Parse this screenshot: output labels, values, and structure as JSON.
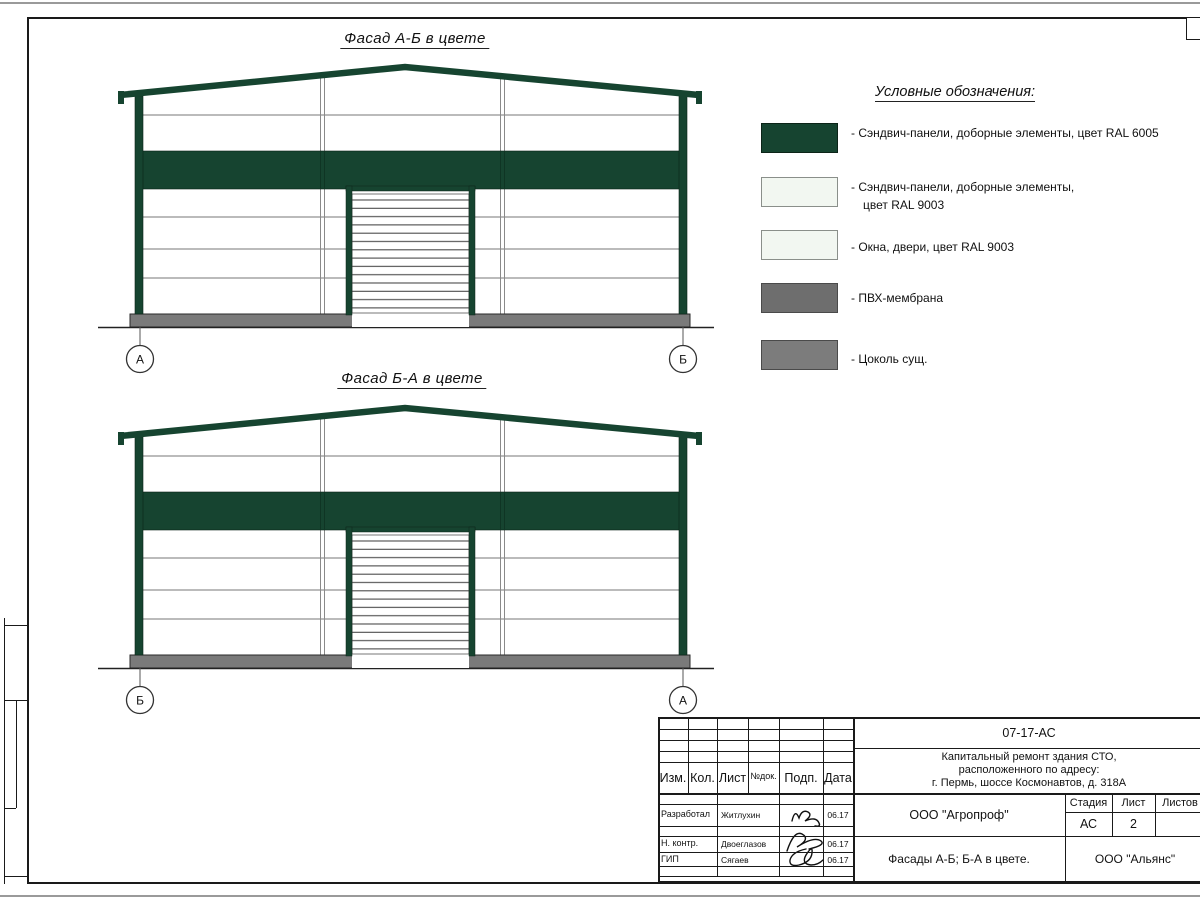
{
  "facades": {
    "ab": {
      "title": "Фасад А-Б в цвете",
      "left_axis": "А",
      "right_axis": "Б"
    },
    "ba": {
      "title": "Фасад Б-А в цвете",
      "left_axis": "Б",
      "right_axis": "А"
    }
  },
  "legend": {
    "title": "Условные обозначения:",
    "items": [
      {
        "color": "#164430",
        "label": "- Сэндвич-панели, доборные элементы,  цвет RAL 6005",
        "label2": ""
      },
      {
        "color": "#f2f7f1",
        "label": "- Сэндвич-панели, доборные элементы,",
        "label2": "цвет RAL 9003"
      },
      {
        "color": "#f2f7f1",
        "label": "- Окна, двери, цвет RAL 9003",
        "label2": ""
      },
      {
        "color": "#6e6e6e",
        "label": "- ПВХ-мембрана",
        "label2": ""
      },
      {
        "color": "#7c7c7c",
        "label": "- Цоколь сущ.",
        "label2": ""
      }
    ]
  },
  "title_block": {
    "code": "07-17-АС",
    "project_lines": [
      "Капитальный ремонт здания СТО,",
      "расположенного по адресу:",
      "г. Пермь, шоссе Космонавтов, д. 318А"
    ],
    "headers": {
      "izm": "Изм.",
      "kol": "Кол.",
      "list": "Лист",
      "ndok": "№док.",
      "podp": "Подп.",
      "data": "Дата"
    },
    "rows": [
      {
        "role": "Разработал",
        "name": "Житлухин",
        "date": "06.17"
      },
      {
        "role": "Н. контр.",
        "name": "Двоеглазов",
        "date": "06.17"
      },
      {
        "role": "ГИП",
        "name": "Сягаев",
        "date": "06.17"
      }
    ],
    "org": "ООО \"Агропроф\"",
    "stage_label": "Стадия",
    "sheet_label": "Лист",
    "sheets_label": "Листов",
    "stage_value": "АС",
    "sheet_value": "2",
    "sheet_title": "Фасады А-Б; Б-А в цвете.",
    "company": "ООО \"Альянс\""
  }
}
